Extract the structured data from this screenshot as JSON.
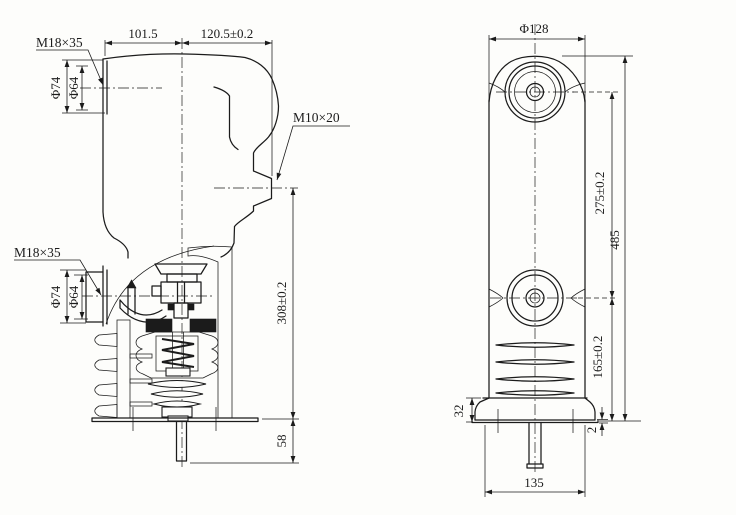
{
  "drawing": {
    "kind": "technical-dimension-drawing",
    "colors": {
      "line": "#1b1b1b",
      "paper": "#fdfdfb"
    },
    "labels": {
      "side": {
        "thread_upper": "M18×35",
        "thread_lower": "M18×35",
        "thread_tip": "M10×20",
        "width_left": "101.5",
        "width_right": "120.5±0.2",
        "upper_outer_dia": "Φ74",
        "upper_inner_dia": "Φ64",
        "lower_outer_dia": "Φ74",
        "lower_inner_dia": "Φ64",
        "height_main": "308±0.2",
        "stem_length": "58"
      },
      "front": {
        "top_dia": "Φ128",
        "center_distance": "275±0.2",
        "total_height": "485",
        "lower_height": "165±0.2",
        "flange_height": "32",
        "step": "2",
        "base_width": "135"
      }
    }
  }
}
